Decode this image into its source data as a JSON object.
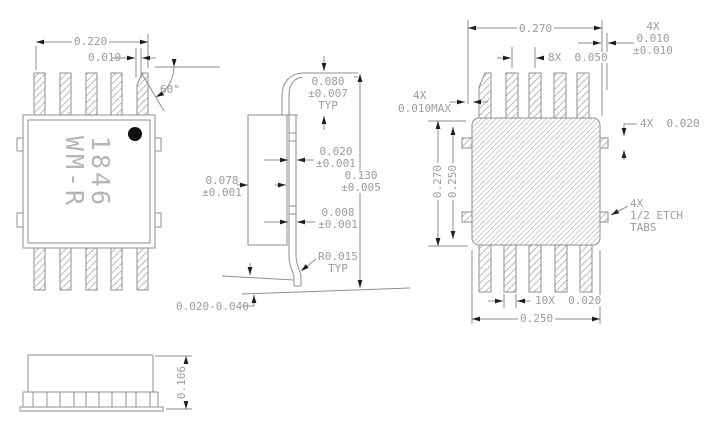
{
  "views": {
    "top": {
      "body_width": "0.220",
      "chamfer_offset": "0.010",
      "chamfer_angle": "60°",
      "marking_line1": "1846",
      "marking_line2": "WM-R"
    },
    "side": {
      "lead_top": "0.080",
      "lead_top_tol": "±0.007",
      "lead_top_typ": "TYP",
      "tab_thickness": "0.020",
      "tab_thickness_tol": "±0.001",
      "body_thickness": "0.078",
      "body_thickness_tol": "±0.001",
      "overall_height": "0.130",
      "overall_height_tol": "±0.005",
      "lead_thickness": "0.008",
      "lead_thickness_tol": "±0.001",
      "bend_radius": "R0.015",
      "bend_radius_typ": "TYP",
      "standoff": "0.020-0.040"
    },
    "bottom": {
      "lead_span": "0.270",
      "corner_qty": "4X",
      "corner_dim": "0.010",
      "corner_tol": "±0.010",
      "lead_pitch": "8X  0.050",
      "gap_qty": "4X",
      "gap_dim": "0.010MAX",
      "height_outer": "0.270",
      "height_inner": "0.250",
      "tab_dim": "4X  0.020",
      "etch_line1": "4X",
      "etch_line2": "1/2 ETCH",
      "etch_line3": "TABS",
      "lead_width": "10X  0.020",
      "body_width": "0.250"
    },
    "front": {
      "height": "0.106"
    }
  },
  "colors": {
    "line": "#8f8f8f",
    "text": "#9c9c9c",
    "arrow": "#1f1f1f",
    "hatch": "#b9b9b9",
    "pin1_dot": "#111111"
  }
}
